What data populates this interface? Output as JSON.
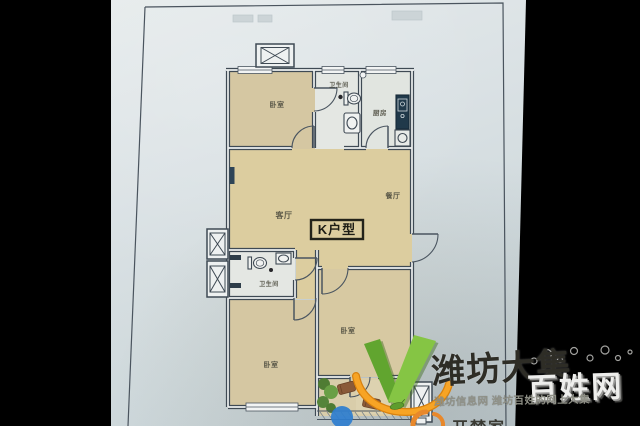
{
  "floor_plan": {
    "unit_label": "K户型",
    "rooms": {
      "bedroom_top": "卧室",
      "bathroom_top": "卫生间",
      "kitchen": "厨房",
      "living_room": "客厅",
      "dining_room": "餐厅",
      "bathroom_lower": "卫生间",
      "bedroom_right": "卧室",
      "bedroom_lower": "卧室"
    }
  },
  "watermark": {
    "brand_main": "潍坊大集",
    "brand_side": "百姓网",
    "tagline": "潍坊信息网 潍坊百姓的网上大集",
    "partial_logo": "开梦家"
  },
  "colors": {
    "background": "#000000",
    "paper": "#d8dfe2",
    "room_tan": "#d6c8a0",
    "wall": "#3f4a54",
    "counter_navy": "#20394a",
    "brand_green": "#76bc3d",
    "brand_orange": "#f6a01f",
    "blue_dot": "#2e7ecf"
  }
}
